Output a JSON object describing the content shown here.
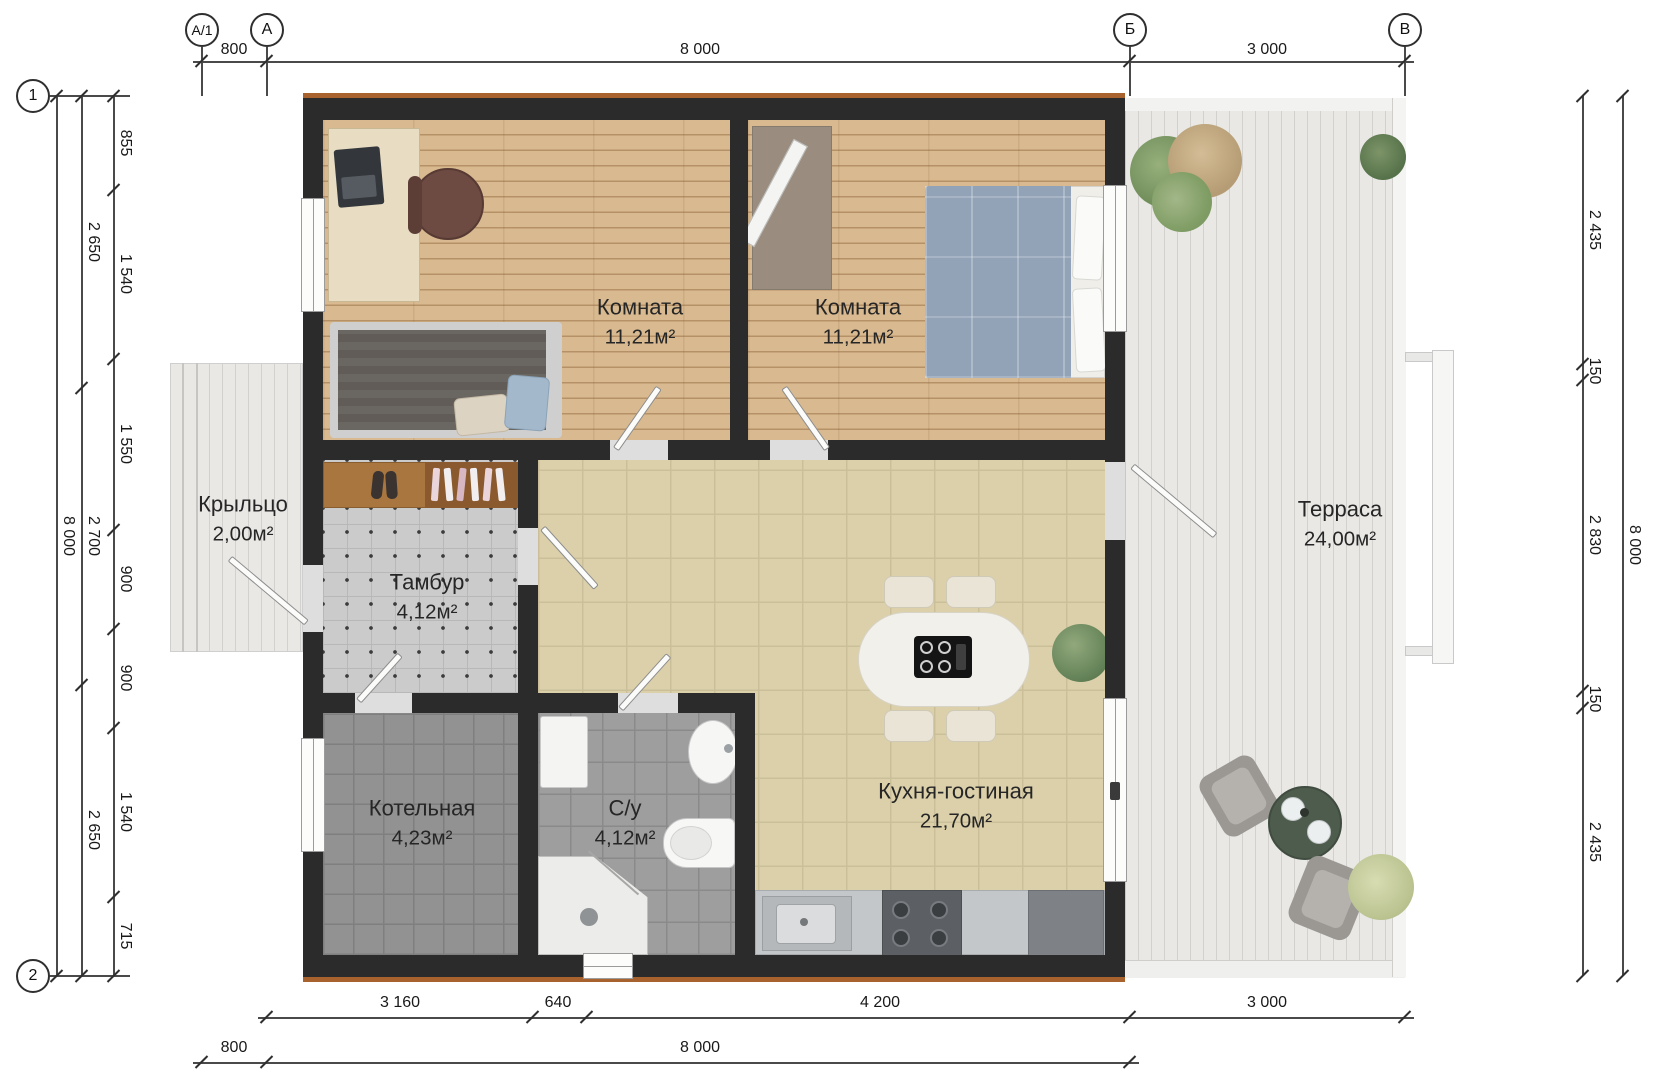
{
  "axes": {
    "a1": "А/1",
    "a": "А",
    "b": "Б",
    "v": "В",
    "r1": "1",
    "r2": "2"
  },
  "dims": {
    "top": {
      "d800": "800",
      "d8000": "8 000",
      "d3000": "3 000"
    },
    "bottom_row1": {
      "d3160": "3 160",
      "d640": "640",
      "d4200": "4 200",
      "d3000": "3 000"
    },
    "bottom_row2": {
      "d800": "800",
      "d8000": "8 000"
    },
    "left_outer": "8 000",
    "left_mid": {
      "m1": "2 650",
      "m2": "2 700",
      "m3": "2 650"
    },
    "left_inner": {
      "i1": "855",
      "i2": "1 540",
      "i3": "1 550",
      "i4": "900",
      "i5": "900",
      "i6": "1 540",
      "i7": "715"
    },
    "right_outer": "8 000",
    "right_inner": {
      "r1": "2 435",
      "r2": "150",
      "r3": "2 830",
      "r4": "150",
      "r5": "2 435"
    }
  },
  "rooms": {
    "room1": {
      "name": "Комната",
      "area": "11,21м²"
    },
    "room2": {
      "name": "Комната",
      "area": "11,21м²"
    },
    "terrace": {
      "name": "Терраса",
      "area": "24,00м²"
    },
    "porch": {
      "name": "Крыльцо",
      "area": "2,00м²"
    },
    "tambour": {
      "name": "Тамбур",
      "area": "4,12м²"
    },
    "boiler": {
      "name": "Котельная",
      "area": "4,23м²"
    },
    "bath": {
      "name": "С/у",
      "area": "4,12м²"
    },
    "kitchen": {
      "name": "Кухня-гостиная",
      "area": "21,70м²"
    }
  },
  "colors": {
    "wall": "#2b2b2b",
    "trim": "#a8622e",
    "wood": "#d9ba90",
    "tile_beige": "#dbd0aa",
    "deck": "#e9e8e5"
  }
}
